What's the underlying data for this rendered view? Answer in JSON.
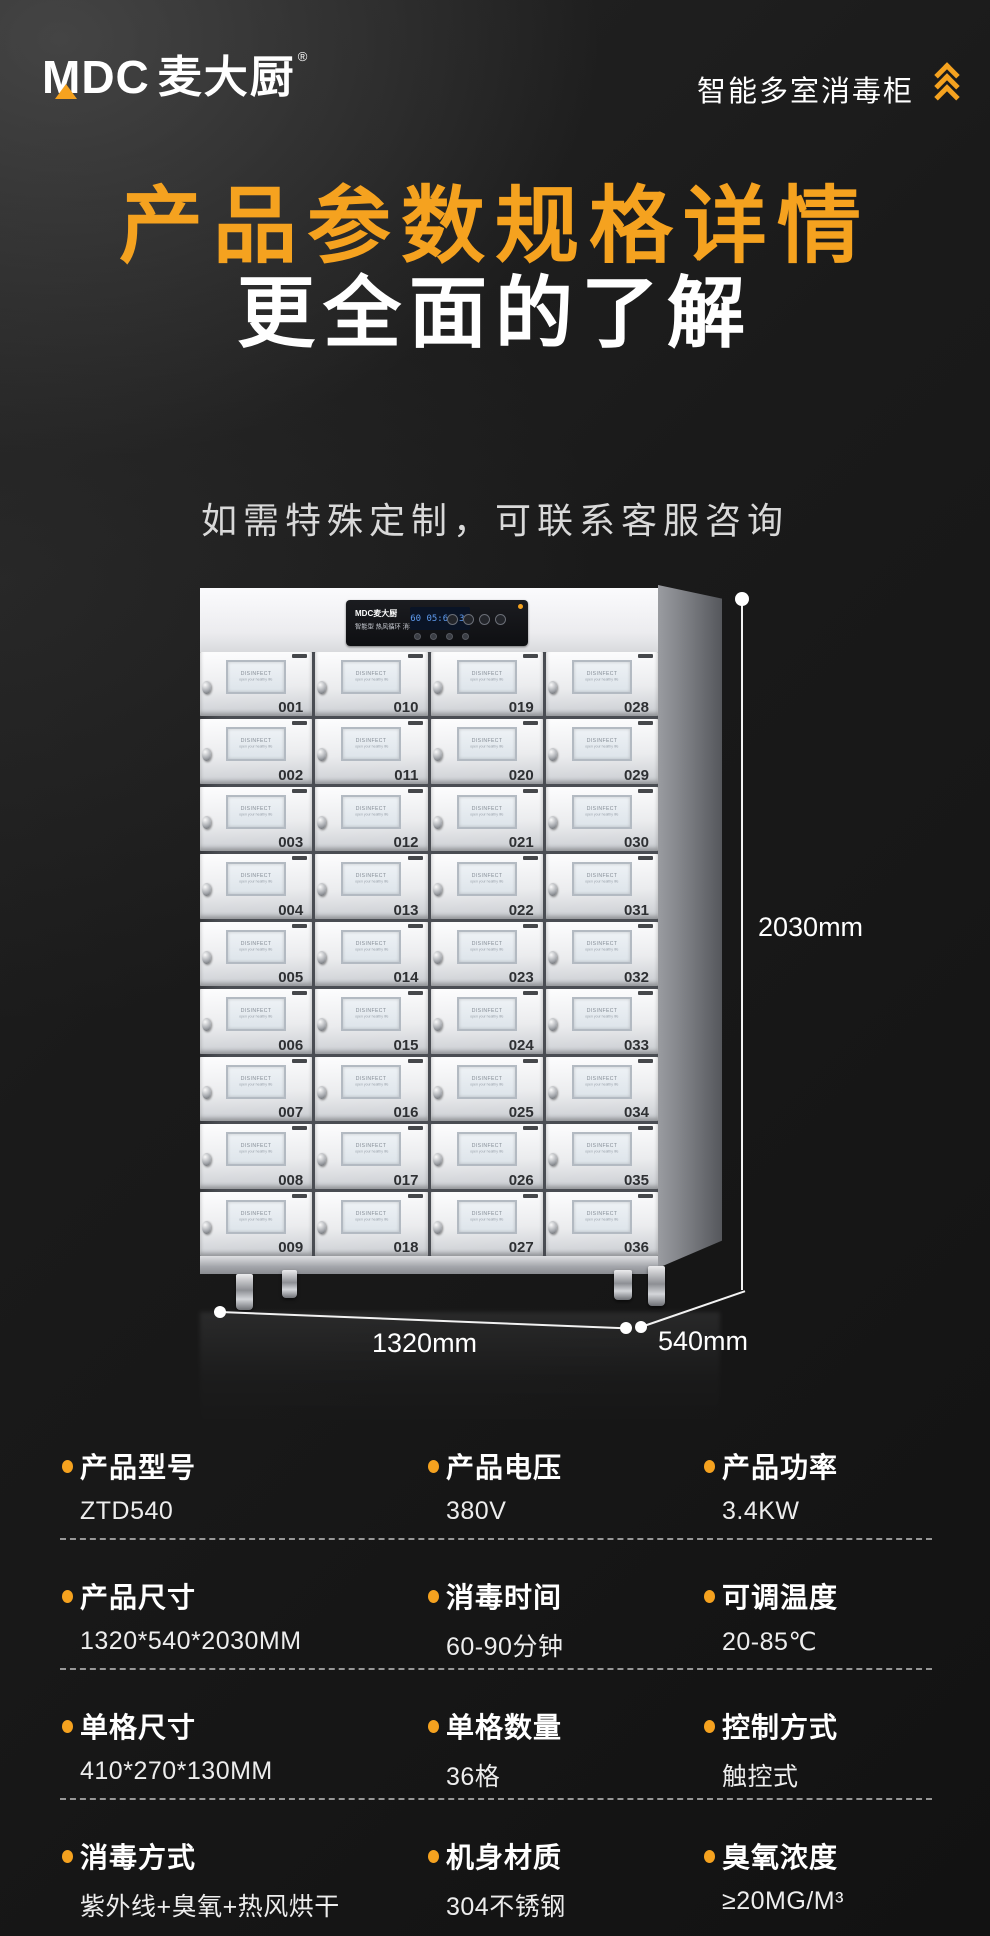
{
  "colors": {
    "accent": "#F5A21F",
    "background": "#161616",
    "title_orange": "#F5A21F",
    "text_white": "#FFFFFF",
    "note_gray": "#D9D9D9"
  },
  "header": {
    "logo_text": "MDC",
    "logo_cn": "麦大厨",
    "logo_reg": "®",
    "right_title": "智能多室消毒柜"
  },
  "hero": {
    "title": "产品参数规格详情",
    "subtitle": "更全面的了解",
    "note": "如需特殊定制，可联系客服咨询"
  },
  "cabinet": {
    "panel": {
      "brand": "MDC麦大厨",
      "line": "智能型 热风循环 消毒柜",
      "lcd": "60 05:60 30"
    },
    "window": {
      "line1": "DISINFECT",
      "line2": "open your healthy life"
    },
    "door_rows": [
      [
        "001",
        "010",
        "019",
        "028"
      ],
      [
        "002",
        "011",
        "020",
        "029"
      ],
      [
        "003",
        "012",
        "021",
        "030"
      ],
      [
        "004",
        "013",
        "022",
        "031"
      ],
      [
        "005",
        "014",
        "023",
        "032"
      ],
      [
        "006",
        "015",
        "024",
        "033"
      ],
      [
        "007",
        "016",
        "025",
        "034"
      ],
      [
        "008",
        "017",
        "026",
        "035"
      ],
      [
        "009",
        "018",
        "027",
        "036"
      ]
    ]
  },
  "dimensions": {
    "height": "2030mm",
    "width": "1320mm",
    "depth": "540mm"
  },
  "specs": {
    "rows": [
      [
        {
          "label": "产品型号",
          "value": "ZTD540"
        },
        {
          "label": "产品电压",
          "value": "380V"
        },
        {
          "label": "产品功率",
          "value": "3.4KW"
        }
      ],
      [
        {
          "label": "产品尺寸",
          "value": "1320*540*2030MM"
        },
        {
          "label": "消毒时间",
          "value": "60-90分钟"
        },
        {
          "label": "可调温度",
          "value": "20-85℃"
        }
      ],
      [
        {
          "label": "单格尺寸",
          "value": "410*270*130MM"
        },
        {
          "label": "单格数量",
          "value": "36格"
        },
        {
          "label": "控制方式",
          "value": "触控式"
        }
      ],
      [
        {
          "label": "消毒方式",
          "value": "紫外线+臭氧+热风烘干"
        },
        {
          "label": "机身材质",
          "value": "304不锈钢"
        },
        {
          "label": "臭氧浓度",
          "value": "≥20MG/M³"
        }
      ]
    ]
  }
}
